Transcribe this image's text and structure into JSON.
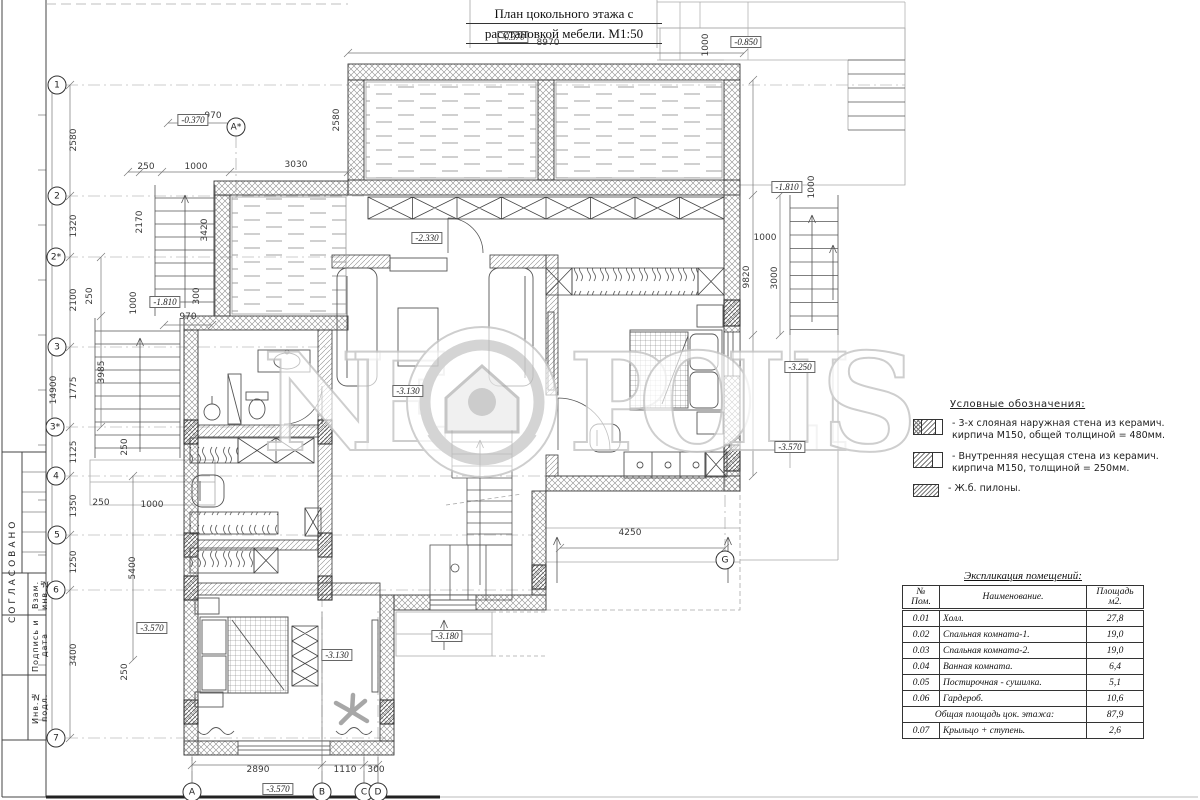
{
  "title": {
    "line1": "План цокольного этажа с",
    "line2": "расстановкой мебели. М1:50"
  },
  "watermark": {
    "left": "NE",
    "right": "POLIS",
    "logo": "neopolis-house-logo",
    "color": "#c6c6c6"
  },
  "stamp": {
    "approved": "СОГЛАСОВАНО",
    "fields": [
      "Взам. инв.№",
      "Подпись и дата",
      "Инв.№ подл."
    ]
  },
  "legend": {
    "title": "Условные обозначения:",
    "items": [
      {
        "symbol": "outer-wall",
        "line1": "- 3-х слояная наружная стена из керамич.",
        "line2": "кирпича М150, общей толщиной = 480мм."
      },
      {
        "symbol": "inner-wall",
        "line1": "- Внутренняя несущая стена из керамич.",
        "line2": "кирпича М150, толщиной = 250мм."
      },
      {
        "symbol": "pylon",
        "line1": "- Ж.б. пилоны.",
        "line2": ""
      }
    ]
  },
  "table": {
    "title": "Экспликация помещений:",
    "headers": [
      "№ Пом.",
      "Наименование.",
      "Площадь м2."
    ],
    "rows": [
      [
        "0.01",
        "Холл.",
        "27,8"
      ],
      [
        "0.02",
        "Спальная комната-1.",
        "19,0"
      ],
      [
        "0.03",
        "Спальная комната-2.",
        "19,0"
      ],
      [
        "0.04",
        "Ванная комната.",
        "6,4"
      ],
      [
        "0.05",
        "Постирочная - сушилка.",
        "5,1"
      ],
      [
        "0.06",
        "Гардероб.",
        "10,6"
      ]
    ],
    "total_row": {
      "label": "Общая площадь цок. этажа:",
      "value": "87,9"
    },
    "footer_row": [
      "0.07",
      "Крыльцо + ступень.",
      "2,6"
    ]
  },
  "plan": {
    "axes": [
      {
        "t": "1",
        "x": 57,
        "y": 85
      },
      {
        "t": "2",
        "x": 57,
        "y": 196
      },
      {
        "t": "2*",
        "x": 56,
        "y": 257
      },
      {
        "t": "3",
        "x": 57,
        "y": 347
      },
      {
        "t": "3*",
        "x": 55,
        "y": 427
      },
      {
        "t": "4",
        "x": 56,
        "y": 476
      },
      {
        "t": "5",
        "x": 57,
        "y": 535
      },
      {
        "t": "6",
        "x": 56,
        "y": 590
      },
      {
        "t": "7",
        "x": 56,
        "y": 738
      },
      {
        "t": "A*",
        "x": 236,
        "y": 127
      },
      {
        "t": "A",
        "x": 192,
        "y": 792
      },
      {
        "t": "B",
        "x": 322,
        "y": 792
      },
      {
        "t": "C",
        "x": 364,
        "y": 792
      },
      {
        "t": "D",
        "x": 378,
        "y": 792
      },
      {
        "t": "G",
        "x": 725,
        "y": 560
      }
    ],
    "elevations": [
      {
        "t": "-0.370",
        "x": 513,
        "y": 37
      },
      {
        "t": "-0.370",
        "x": 193,
        "y": 120
      },
      {
        "t": "-0.850",
        "x": 746,
        "y": 42
      },
      {
        "t": "-1.810",
        "x": 787,
        "y": 187
      },
      {
        "t": "-1.810",
        "x": 165,
        "y": 302
      },
      {
        "t": "-2.330",
        "x": 427,
        "y": 238
      },
      {
        "t": "-3.130",
        "x": 408,
        "y": 391
      },
      {
        "t": "-3.250",
        "x": 800,
        "y": 367
      },
      {
        "t": "-3.570",
        "x": 790,
        "y": 447
      },
      {
        "t": "-3.570",
        "x": 152,
        "y": 628
      },
      {
        "t": "-3.130",
        "x": 337,
        "y": 655
      },
      {
        "t": "-3.180",
        "x": 447,
        "y": 636
      },
      {
        "t": "-3.570",
        "x": 278,
        "y": 789
      }
    ],
    "dimensions": [
      {
        "t": "8970",
        "x": 548,
        "y": 43
      },
      {
        "t": "970",
        "x": 213,
        "y": 116
      },
      {
        "t": "250",
        "x": 146,
        "y": 167
      },
      {
        "t": "1000",
        "x": 196,
        "y": 167
      },
      {
        "t": "3030",
        "x": 296,
        "y": 165
      },
      {
        "t": "2580",
        "x": 337,
        "y": 120,
        "r": 1
      },
      {
        "t": "1000",
        "x": 706,
        "y": 45,
        "r": 1
      },
      {
        "t": "2580",
        "x": 74,
        "y": 140,
        "r": 1
      },
      {
        "t": "1320",
        "x": 74,
        "y": 226,
        "r": 1
      },
      {
        "t": "2100",
        "x": 74,
        "y": 300,
        "r": 1
      },
      {
        "t": "1775",
        "x": 74,
        "y": 388,
        "r": 1
      },
      {
        "t": "1125",
        "x": 74,
        "y": 452,
        "r": 1
      },
      {
        "t": "1350",
        "x": 74,
        "y": 506,
        "r": 1
      },
      {
        "t": "1250",
        "x": 74,
        "y": 562,
        "r": 1
      },
      {
        "t": "3400",
        "x": 74,
        "y": 655,
        "r": 1
      },
      {
        "t": "14900",
        "x": 54,
        "y": 390,
        "r": 1
      },
      {
        "t": "3985",
        "x": 102,
        "y": 372,
        "r": 1
      },
      {
        "t": "2170",
        "x": 140,
        "y": 222,
        "r": 1
      },
      {
        "t": "3420",
        "x": 205,
        "y": 230,
        "r": 1
      },
      {
        "t": "250",
        "x": 90,
        "y": 296,
        "r": 1
      },
      {
        "t": "1000",
        "x": 134,
        "y": 303,
        "r": 1
      },
      {
        "t": "300",
        "x": 197,
        "y": 296,
        "r": 1
      },
      {
        "t": "970",
        "x": 188,
        "y": 317
      },
      {
        "t": "250",
        "x": 125,
        "y": 447,
        "r": 1
      },
      {
        "t": "250",
        "x": 101,
        "y": 503
      },
      {
        "t": "1000",
        "x": 152,
        "y": 505
      },
      {
        "t": "5400",
        "x": 133,
        "y": 568,
        "r": 1
      },
      {
        "t": "250",
        "x": 125,
        "y": 672,
        "r": 1
      },
      {
        "t": "1000",
        "x": 812,
        "y": 187,
        "r": 1
      },
      {
        "t": "1000",
        "x": 765,
        "y": 238
      },
      {
        "t": "9820",
        "x": 747,
        "y": 277,
        "r": 1
      },
      {
        "t": "3000",
        "x": 775,
        "y": 278,
        "r": 1
      },
      {
        "t": "4250",
        "x": 630,
        "y": 533
      },
      {
        "t": "2890",
        "x": 258,
        "y": 770
      },
      {
        "t": "1110",
        "x": 345,
        "y": 770
      },
      {
        "t": "300",
        "x": 376,
        "y": 770
      }
    ]
  }
}
